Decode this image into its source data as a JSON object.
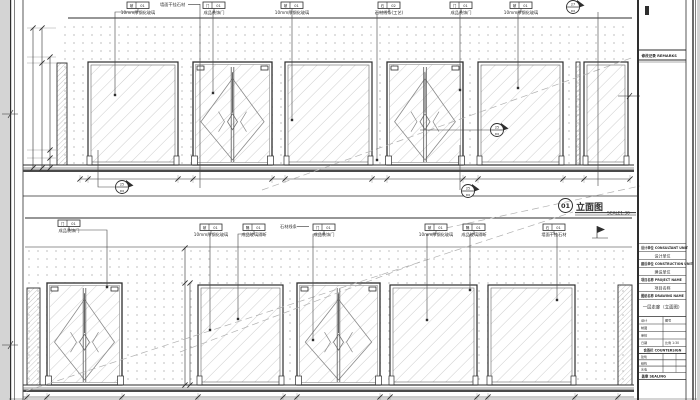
{
  "colors": {
    "paper": "#ffffff",
    "margin": "#d4d4d4",
    "ink": "#2e2e2e",
    "mid": "#5a5a5a",
    "hatch": "#b8b8b8",
    "dots": "#c9c9c9",
    "floor": "#4a4a4a"
  },
  "sheet": {
    "corner_mark": "专"
  },
  "view_title": {
    "number": "01",
    "name": "立面图",
    "scale": "SCALE1:30"
  },
  "drawing": {
    "separator_y": 196,
    "elevations": [
      {
        "id": "elevation-top",
        "ceil": [
          68,
          18,
          632
        ],
        "wall": [
          57,
          26,
          571,
          139
        ],
        "floor": [
          23,
          165,
          634
        ],
        "panels": [
          [
            "strip",
            57,
            63,
            10,
            102
          ],
          [
            "glass",
            88,
            62,
            90,
            103
          ],
          [
            "door",
            193,
            62,
            79,
            103
          ],
          [
            "glass",
            285,
            62,
            87,
            103
          ],
          [
            "door",
            387,
            62,
            76,
            103
          ],
          [
            "glass",
            478,
            62,
            85,
            103
          ],
          [
            "strip",
            576,
            62,
            4,
            103
          ],
          [
            "glass",
            584,
            62,
            44,
            103
          ]
        ],
        "dim": {
          "y": 179,
          "x1": 80,
          "x2": 630,
          "ticks": [
            80,
            88,
            178,
            193,
            272,
            285,
            372,
            387,
            463,
            478,
            563,
            584,
            630
          ]
        }
      },
      {
        "id": "elevation-bottom",
        "ceil": [
          25,
          218,
          632
        ],
        "soffit": [
          25,
          247,
          632
        ],
        "wall": [
          25,
          248,
          605,
          137
        ],
        "floor": [
          23,
          385,
          634
        ],
        "panels": [
          [
            "strip",
            27,
            288,
            13,
            97
          ],
          [
            "door",
            47,
            283,
            75,
            102
          ],
          [
            "glass",
            198,
            285,
            85,
            100
          ],
          [
            "door",
            297,
            283,
            83,
            102
          ],
          [
            "glass",
            390,
            285,
            87,
            100
          ],
          [
            "glass",
            488,
            285,
            87,
            100
          ],
          [
            "strip",
            618,
            285,
            14,
            100
          ]
        ],
        "dim": {
          "y": 397,
          "x1": 23,
          "x2": 634,
          "ticks": [
            27,
            47,
            122,
            198,
            283,
            297,
            380,
            390,
            477,
            488,
            575,
            618
          ]
        }
      }
    ],
    "diagonals": [
      [
        262,
        190,
        634,
        57
      ],
      [
        446,
        228,
        640,
        186
      ],
      [
        26,
        391,
        573,
        212
      ],
      [
        180,
        352,
        420,
        262
      ]
    ],
    "vdims_left": {
      "lines": [
        [
          33,
          28,
          168
        ],
        [
          42,
          28,
          168
        ],
        [
          50,
          57,
          168
        ]
      ],
      "ext_ys": [
        28,
        57,
        63,
        150,
        158,
        168
      ]
    },
    "vdims_mid": [
      [
        185,
        248,
        385
      ],
      [
        190,
        283,
        385
      ]
    ],
    "tags": [
      {
        "x": 127,
        "y": 2,
        "cells": [
          "玻",
          "01"
        ],
        "caption": "10mm厚钢化玻璃",
        "dot": [
          115,
          95
        ]
      },
      {
        "x": 203,
        "y": 2,
        "cells": [
          "门",
          "01"
        ],
        "caption": "成品装饰门",
        "dot": [
          213,
          93
        ]
      },
      {
        "x": 281,
        "y": 2,
        "cells": [
          "玻",
          "01"
        ],
        "caption": "10mm厚钢化玻璃",
        "dot": [
          292,
          120
        ]
      },
      {
        "x": 378,
        "y": 2,
        "cells": [
          "石",
          "02"
        ],
        "caption": "石材线条(工艺)",
        "dot": [
          377,
          160
        ]
      },
      {
        "x": 450,
        "y": 2,
        "cells": [
          "门",
          "01"
        ],
        "caption": "成品装饰门",
        "dot": [
          460,
          90
        ]
      },
      {
        "x": 510,
        "y": 2,
        "cells": [
          "玻",
          "01"
        ],
        "caption": "10mm厚钢化玻璃",
        "dot": [
          518,
          88
        ]
      },
      {
        "x": 58,
        "y": 220,
        "cells": [
          "门",
          "01"
        ],
        "caption": "成品装饰门",
        "dot": [
          107,
          287
        ]
      },
      {
        "x": 200,
        "y": 224,
        "cells": [
          "玻",
          "01"
        ],
        "caption": "10mm厚钢化玻璃",
        "dot": [
          210,
          330
        ]
      },
      {
        "x": 243,
        "y": 224,
        "cells": [
          "隔",
          "01"
        ],
        "caption": "成品玻璃隔断",
        "dot": [
          238,
          319
        ]
      },
      {
        "x": 313,
        "y": 224,
        "cells": [
          "门",
          "01"
        ],
        "caption": "成品装饰门",
        "dot": [
          313,
          340
        ]
      },
      {
        "x": 425,
        "y": 224,
        "cells": [
          "玻",
          "01"
        ],
        "caption": "10mm厚钢化玻璃",
        "dot": [
          427,
          320
        ]
      },
      {
        "x": 463,
        "y": 224,
        "cells": [
          "隔",
          "01"
        ],
        "caption": "成品玻璃隔断",
        "dot": [
          470,
          290
        ]
      },
      {
        "x": 543,
        "y": 224,
        "cells": [
          "石",
          "01"
        ],
        "caption": "墙面干挂石材",
        "dot": [
          557,
          300
        ]
      }
    ],
    "labels": [
      {
        "x": 160,
        "y": 6,
        "text": "墙面干挂石材",
        "dash": [
          188,
          200
        ]
      },
      {
        "x": 280,
        "y": 228,
        "text": "石材线条",
        "dash": [
          297,
          309
        ]
      }
    ],
    "bubbles": [
      {
        "cx": 122,
        "cy": 187,
        "top": "25",
        "bot": "D6",
        "leader": [
          [
            98,
            150
          ],
          [
            98,
            187
          ],
          [
            115,
            187
          ]
        ]
      },
      {
        "cx": 468,
        "cy": 191,
        "top": "25",
        "bot": "D6",
        "leader": [
          [
            460,
            145
          ],
          [
            460,
            190
          ]
        ]
      },
      {
        "cx": 497,
        "cy": 130,
        "top": "25",
        "bot": "D6",
        "leader": [
          [
            420,
            130
          ],
          [
            490,
            130
          ]
        ]
      },
      {
        "cx": 573,
        "cy": 7,
        "top": "27",
        "bot": "D6",
        "leader": []
      }
    ],
    "leader_lines": [
      [
        598,
        12,
        598,
        186
      ],
      [
        200,
        4,
        200,
        188
      ]
    ],
    "flag": {
      "x": 600,
      "y": 231
    }
  },
  "titleblock": {
    "remarks_header": "修改记录 REMARKS",
    "rows": [
      {
        "header": "设计单位 CONSULTANT UNIT",
        "value": "设计单位"
      },
      {
        "header": "建设单位 CONSTRUCTION UNIT",
        "value": "建设单位"
      },
      {
        "header": "项目名称 PROJECT NAME",
        "value": "项目名称"
      },
      {
        "header": "图纸名称 DRAWING NAME",
        "value": "一层走廊（立面图）"
      }
    ],
    "meta_rows": [
      [
        "设计",
        "图号"
      ],
      [
        "制图",
        ""
      ],
      [
        "审核",
        ""
      ],
      [
        "日期",
        "比例 1:30"
      ]
    ],
    "countersign_header": "会签栏 COUNTERSIGN",
    "countersign_rows": [
      [
        "建筑",
        ""
      ],
      [
        "结构",
        ""
      ],
      [
        "水电",
        ""
      ]
    ],
    "sealing_header": "盖章 SEALING"
  }
}
